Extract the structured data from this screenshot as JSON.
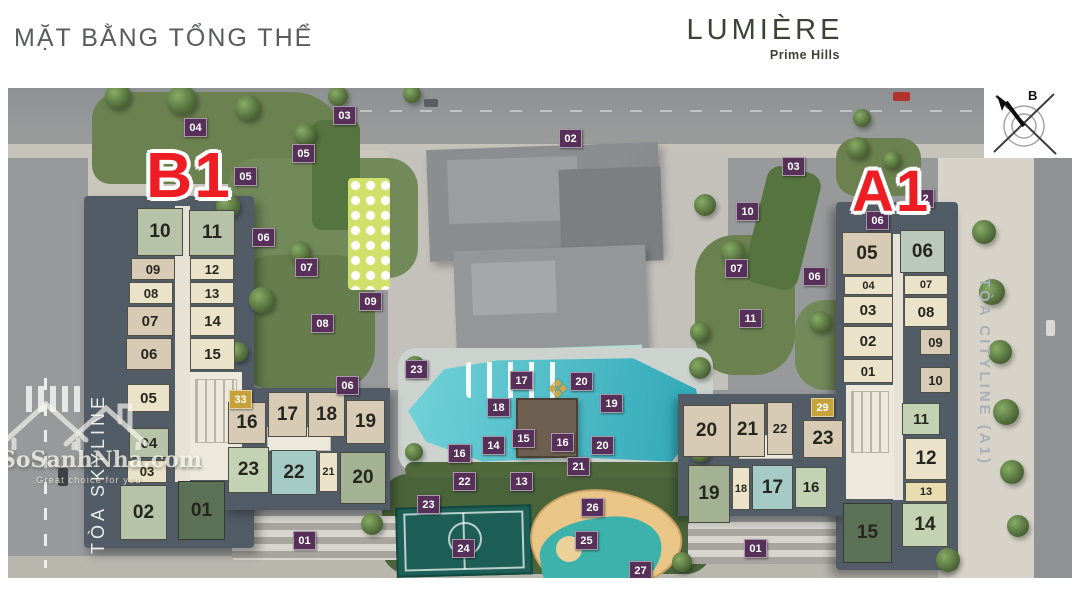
{
  "header": {
    "title": "MẶT BẰNG TỔNG THỂ",
    "brand": "LUMIÈRE",
    "brand_sub": "Prime Hills"
  },
  "compass": {
    "north_label": "B"
  },
  "watermark": {
    "site": "SoSanhNha.com",
    "tagline": "Great choice for you"
  },
  "towers": {
    "b1": {
      "label": "B1",
      "name": "TÒA SKYLINE"
    },
    "a1": {
      "label": "A1",
      "name": "TÒA CITYLINE (A1)"
    }
  },
  "palette": {
    "sage": "#b7c3a9",
    "tan": "#d7cbb6",
    "cream": "#ebe3c9",
    "creamy": "#e9dcb0",
    "lightsage": "#c3d2b2",
    "teal": "#a6cac6",
    "sage2": "#a2b292",
    "sagegray": "#bac9bb",
    "darkgreen": "#5c7257",
    "badge_purple": "#57305a",
    "badge_gold": "#c7a23b",
    "tower_red": "#ee1d23",
    "pool_light": "#73d2d8",
    "pool_dark": "#2da6b6",
    "court_green": "#1d5f56",
    "roof_base": "#525c66"
  },
  "units": [
    {
      "t": "b1",
      "n": "10",
      "x": 137,
      "y": 208,
      "w": 46,
      "h": 48,
      "c": "sage"
    },
    {
      "t": "b1",
      "n": "11",
      "x": 189,
      "y": 210,
      "w": 46,
      "h": 46,
      "c": "sage"
    },
    {
      "t": "b1",
      "n": "09",
      "x": 131,
      "y": 258,
      "w": 44,
      "h": 22,
      "c": "tan"
    },
    {
      "t": "b1",
      "n": "12",
      "x": 190,
      "y": 258,
      "w": 44,
      "h": 22,
      "c": "cream"
    },
    {
      "t": "b1",
      "n": "08",
      "x": 129,
      "y": 282,
      "w": 44,
      "h": 22,
      "c": "cream"
    },
    {
      "t": "b1",
      "n": "13",
      "x": 190,
      "y": 282,
      "w": 44,
      "h": 22,
      "c": "cream"
    },
    {
      "t": "b1",
      "n": "07",
      "x": 127,
      "y": 306,
      "w": 46,
      "h": 30,
      "c": "tan"
    },
    {
      "t": "b1",
      "n": "14",
      "x": 190,
      "y": 306,
      "w": 45,
      "h": 30,
      "c": "cream"
    },
    {
      "t": "b1",
      "n": "06",
      "x": 126,
      "y": 338,
      "w": 46,
      "h": 32,
      "c": "tan"
    },
    {
      "t": "b1",
      "n": "15",
      "x": 190,
      "y": 338,
      "w": 45,
      "h": 32,
      "c": "cream"
    },
    {
      "t": "b1",
      "n": "05",
      "x": 127,
      "y": 384,
      "w": 43,
      "h": 28,
      "c": "cream"
    },
    {
      "t": "b1",
      "n": "04",
      "x": 129,
      "y": 428,
      "w": 40,
      "h": 30,
      "c": "sage"
    },
    {
      "t": "b1",
      "n": "03",
      "x": 127,
      "y": 460,
      "w": 40,
      "h": 23,
      "c": "cream"
    },
    {
      "t": "b1",
      "n": "02",
      "x": 120,
      "y": 485,
      "w": 47,
      "h": 55,
      "c": "sage"
    },
    {
      "t": "b1",
      "n": "01",
      "x": 178,
      "y": 481,
      "w": 47,
      "h": 59,
      "c": "darkgreen"
    },
    {
      "t": "b1",
      "n": "16",
      "x": 228,
      "y": 402,
      "w": 38,
      "h": 42,
      "c": "tan"
    },
    {
      "t": "b1",
      "n": "17",
      "x": 268,
      "y": 392,
      "w": 39,
      "h": 45,
      "c": "tan"
    },
    {
      "t": "b1",
      "n": "18",
      "x": 308,
      "y": 392,
      "w": 37,
      "h": 45,
      "c": "tan"
    },
    {
      "t": "b1",
      "n": "19",
      "x": 346,
      "y": 400,
      "w": 39,
      "h": 44,
      "c": "tan"
    },
    {
      "t": "b1",
      "n": "23",
      "x": 228,
      "y": 447,
      "w": 41,
      "h": 46,
      "c": "lightsage"
    },
    {
      "t": "b1",
      "n": "22",
      "x": 271,
      "y": 450,
      "w": 46,
      "h": 45,
      "c": "teal"
    },
    {
      "t": "b1",
      "n": "21",
      "x": 319,
      "y": 452,
      "w": 19,
      "h": 40,
      "c": "cream"
    },
    {
      "t": "b1",
      "n": "20",
      "x": 340,
      "y": 452,
      "w": 46,
      "h": 52,
      "c": "sage2"
    },
    {
      "t": "a1",
      "n": "05",
      "x": 842,
      "y": 232,
      "w": 50,
      "h": 43,
      "c": "tan"
    },
    {
      "t": "a1",
      "n": "04",
      "x": 844,
      "y": 276,
      "w": 49,
      "h": 19,
      "c": "cream"
    },
    {
      "t": "a1",
      "n": "03",
      "x": 843,
      "y": 296,
      "w": 50,
      "h": 28,
      "c": "cream"
    },
    {
      "t": "a1",
      "n": "02",
      "x": 843,
      "y": 326,
      "w": 50,
      "h": 31,
      "c": "cream"
    },
    {
      "t": "a1",
      "n": "01",
      "x": 843,
      "y": 359,
      "w": 50,
      "h": 24,
      "c": "cream"
    },
    {
      "t": "a1",
      "n": "06",
      "x": 900,
      "y": 230,
      "w": 45,
      "h": 43,
      "c": "sagegray"
    },
    {
      "t": "a1",
      "n": "07",
      "x": 904,
      "y": 275,
      "w": 44,
      "h": 20,
      "c": "cream"
    },
    {
      "t": "a1",
      "n": "08",
      "x": 904,
      "y": 297,
      "w": 44,
      "h": 30,
      "c": "cream"
    },
    {
      "t": "a1",
      "n": "09",
      "x": 920,
      "y": 329,
      "w": 31,
      "h": 26,
      "c": "tan"
    },
    {
      "t": "a1",
      "n": "10",
      "x": 920,
      "y": 367,
      "w": 31,
      "h": 26,
      "c": "tan"
    },
    {
      "t": "a1",
      "n": "11",
      "x": 902,
      "y": 403,
      "w": 38,
      "h": 32,
      "c": "lightsage"
    },
    {
      "t": "a1",
      "n": "12",
      "x": 905,
      "y": 438,
      "w": 42,
      "h": 42,
      "c": "cream"
    },
    {
      "t": "a1",
      "n": "13",
      "x": 905,
      "y": 482,
      "w": 42,
      "h": 20,
      "c": "creamy"
    },
    {
      "t": "a1",
      "n": "14",
      "x": 902,
      "y": 503,
      "w": 46,
      "h": 44,
      "c": "lightsage"
    },
    {
      "t": "a1",
      "n": "15",
      "x": 843,
      "y": 503,
      "w": 49,
      "h": 60,
      "c": "darkgreen"
    },
    {
      "t": "a1",
      "n": "20",
      "x": 683,
      "y": 405,
      "w": 47,
      "h": 52,
      "c": "tan"
    },
    {
      "t": "a1",
      "n": "21",
      "x": 730,
      "y": 403,
      "w": 35,
      "h": 54,
      "c": "tan"
    },
    {
      "t": "a1",
      "n": "22",
      "x": 767,
      "y": 402,
      "w": 26,
      "h": 53,
      "c": "tan"
    },
    {
      "t": "a1",
      "n": "23",
      "x": 803,
      "y": 420,
      "w": 40,
      "h": 38,
      "c": "tan"
    },
    {
      "t": "a1",
      "n": "19",
      "x": 688,
      "y": 465,
      "w": 42,
      "h": 58,
      "c": "sage2"
    },
    {
      "t": "a1",
      "n": "18",
      "x": 732,
      "y": 467,
      "w": 18,
      "h": 43,
      "c": "cream"
    },
    {
      "t": "a1",
      "n": "17",
      "x": 752,
      "y": 465,
      "w": 41,
      "h": 45,
      "c": "teal"
    },
    {
      "t": "a1",
      "n": "16",
      "x": 795,
      "y": 467,
      "w": 32,
      "h": 41,
      "c": "lightsage"
    }
  ],
  "badges": [
    {
      "n": "04",
      "x": 195,
      "y": 127,
      "k": "purple"
    },
    {
      "n": "03",
      "x": 344,
      "y": 115,
      "k": "purple"
    },
    {
      "n": "05",
      "x": 303,
      "y": 153,
      "k": "purple"
    },
    {
      "n": "05",
      "x": 245,
      "y": 176,
      "k": "purple"
    },
    {
      "n": "02",
      "x": 570,
      "y": 138,
      "k": "purple"
    },
    {
      "n": "03",
      "x": 793,
      "y": 166,
      "k": "purple"
    },
    {
      "n": "10",
      "x": 747,
      "y": 211,
      "k": "purple"
    },
    {
      "n": "12",
      "x": 922,
      "y": 198,
      "k": "purple"
    },
    {
      "n": "06",
      "x": 877,
      "y": 220,
      "k": "purple"
    },
    {
      "n": "06",
      "x": 263,
      "y": 237,
      "k": "purple"
    },
    {
      "n": "07",
      "x": 306,
      "y": 267,
      "k": "purple"
    },
    {
      "n": "07",
      "x": 736,
      "y": 268,
      "k": "purple"
    },
    {
      "n": "06",
      "x": 814,
      "y": 276,
      "k": "purple"
    },
    {
      "n": "09",
      "x": 370,
      "y": 301,
      "k": "purple"
    },
    {
      "n": "08",
      "x": 322,
      "y": 323,
      "k": "purple"
    },
    {
      "n": "11",
      "x": 750,
      "y": 318,
      "k": "purple"
    },
    {
      "n": "06",
      "x": 347,
      "y": 385,
      "k": "purple"
    },
    {
      "n": "23",
      "x": 416,
      "y": 369,
      "k": "purple"
    },
    {
      "n": "17",
      "x": 521,
      "y": 380,
      "k": "purple"
    },
    {
      "n": "20",
      "x": 581,
      "y": 381,
      "k": "purple"
    },
    {
      "n": "18",
      "x": 498,
      "y": 407,
      "k": "purple"
    },
    {
      "n": "19",
      "x": 611,
      "y": 403,
      "k": "purple"
    },
    {
      "n": "16",
      "x": 459,
      "y": 453,
      "k": "purple"
    },
    {
      "n": "14",
      "x": 493,
      "y": 445,
      "k": "purple"
    },
    {
      "n": "15",
      "x": 523,
      "y": 438,
      "k": "purple"
    },
    {
      "n": "16",
      "x": 562,
      "y": 442,
      "k": "purple"
    },
    {
      "n": "20",
      "x": 602,
      "y": 445,
      "k": "purple"
    },
    {
      "n": "21",
      "x": 578,
      "y": 466,
      "k": "purple"
    },
    {
      "n": "22",
      "x": 464,
      "y": 481,
      "k": "purple"
    },
    {
      "n": "13",
      "x": 521,
      "y": 481,
      "k": "purple"
    },
    {
      "n": "23",
      "x": 428,
      "y": 504,
      "k": "purple"
    },
    {
      "n": "26",
      "x": 592,
      "y": 507,
      "k": "purple"
    },
    {
      "n": "25",
      "x": 586,
      "y": 540,
      "k": "purple"
    },
    {
      "n": "24",
      "x": 463,
      "y": 548,
      "k": "purple"
    },
    {
      "n": "27",
      "x": 640,
      "y": 570,
      "k": "purple"
    },
    {
      "n": "01",
      "x": 304,
      "y": 540,
      "k": "purple"
    },
    {
      "n": "01",
      "x": 755,
      "y": 548,
      "k": "purple"
    },
    {
      "n": "33",
      "x": 240,
      "y": 399,
      "k": "gold"
    },
    {
      "n": "29",
      "x": 822,
      "y": 407,
      "k": "gold"
    }
  ]
}
